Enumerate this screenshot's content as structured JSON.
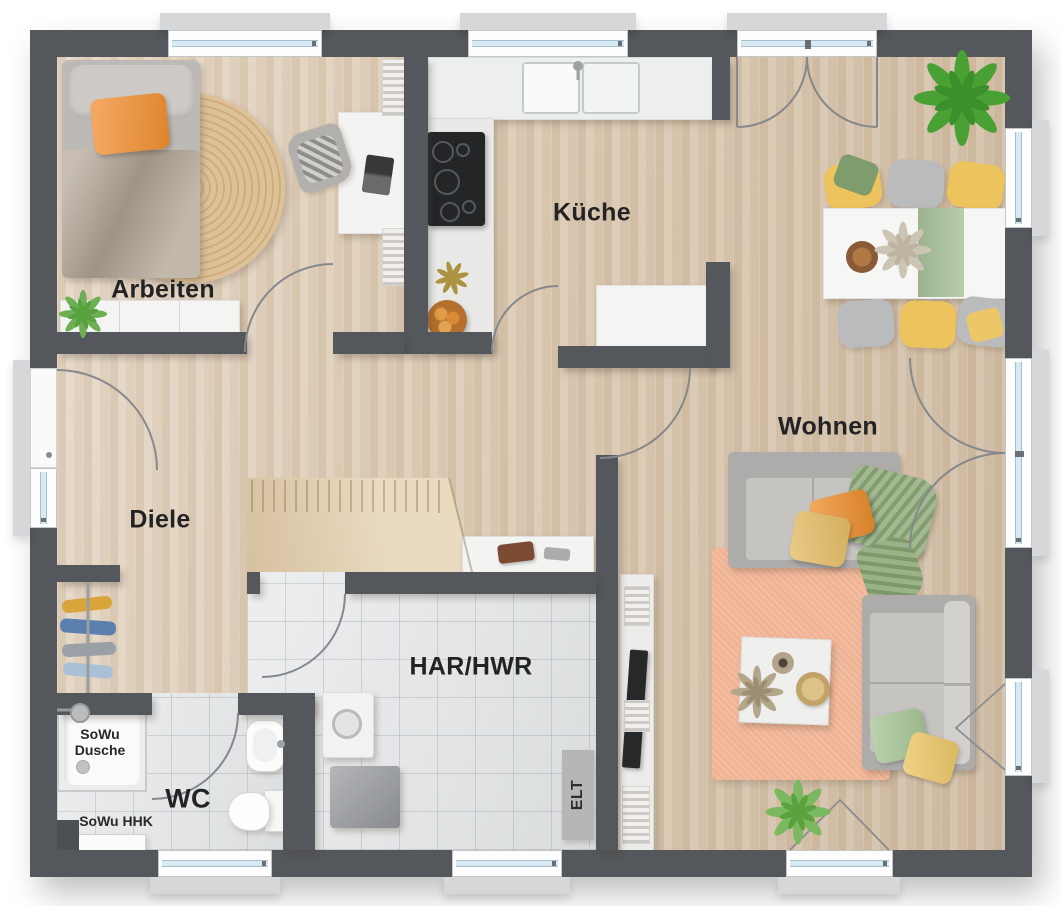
{
  "meta": {
    "kind": "residential floor plan, top-down 3D render"
  },
  "rooms": {
    "arbeiten": {
      "label": "Arbeiten"
    },
    "kueche": {
      "label": "Küche"
    },
    "wohnen": {
      "label": "Wohnen"
    },
    "diele": {
      "label": "Diele"
    },
    "har_hwr": {
      "label": "HAR/HWR"
    },
    "wc": {
      "label": "WC"
    }
  },
  "annotations": {
    "shower_label_lines": [
      "SoWu",
      "Dusche"
    ],
    "heater_label": "SoWu HHK",
    "electrical_label": "ELT"
  },
  "colors": {
    "wall": "#54575b",
    "wood_floor": "#dbc9b2",
    "tile_floor": "#e4e6e7",
    "living_rug": "#f0b394",
    "round_rug": "#d8bc92",
    "sofa_grey": "#b5b3b0",
    "accent_orange": "#f0902f",
    "accent_yellow": "#ecc768",
    "accent_green": "#9ab886",
    "plant_green": "#5aa53e",
    "stairs_wood": "#e3cfae",
    "window_glass": "#d7e9f3"
  }
}
